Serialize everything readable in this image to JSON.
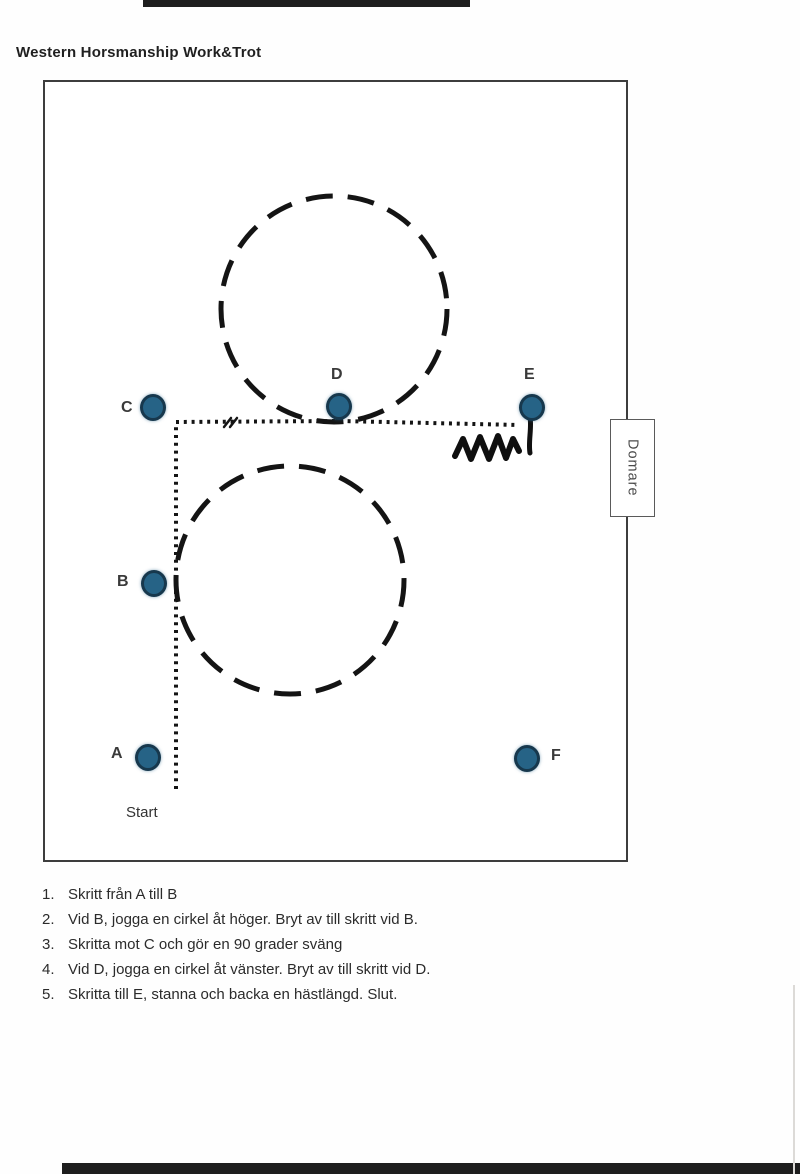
{
  "page": {
    "title": "Western Horsmanship Work&Trot"
  },
  "arena": {
    "judge_label": "Domare",
    "start_label": "Start",
    "markers": [
      {
        "id": "A",
        "label": "A"
      },
      {
        "id": "B",
        "label": "B"
      },
      {
        "id": "C",
        "label": "C"
      },
      {
        "id": "D",
        "label": "D"
      },
      {
        "id": "E",
        "label": "E"
      },
      {
        "id": "F",
        "label": "F"
      }
    ]
  },
  "instructions": [
    {
      "num": "1.",
      "text": "Skritt från A till B"
    },
    {
      "num": "2.",
      "text": "Vid B, jogga en cirkel åt höger. Bryt av till skritt vid B."
    },
    {
      "num": "3.",
      "text": "Skritta mot C och gör en 90 grader sväng"
    },
    {
      "num": "4.",
      "text": "Vid D, jogga en cirkel åt vänster. Bryt av till skritt vid D."
    },
    {
      "num": "5.",
      "text": "Skritta till E, stanna och backa en hästlängd. Slut."
    }
  ],
  "colors": {
    "marker_fill": "#266386",
    "marker_border": "#17384d",
    "path_line": "#141414",
    "arena_border": "#3d3d3d"
  }
}
